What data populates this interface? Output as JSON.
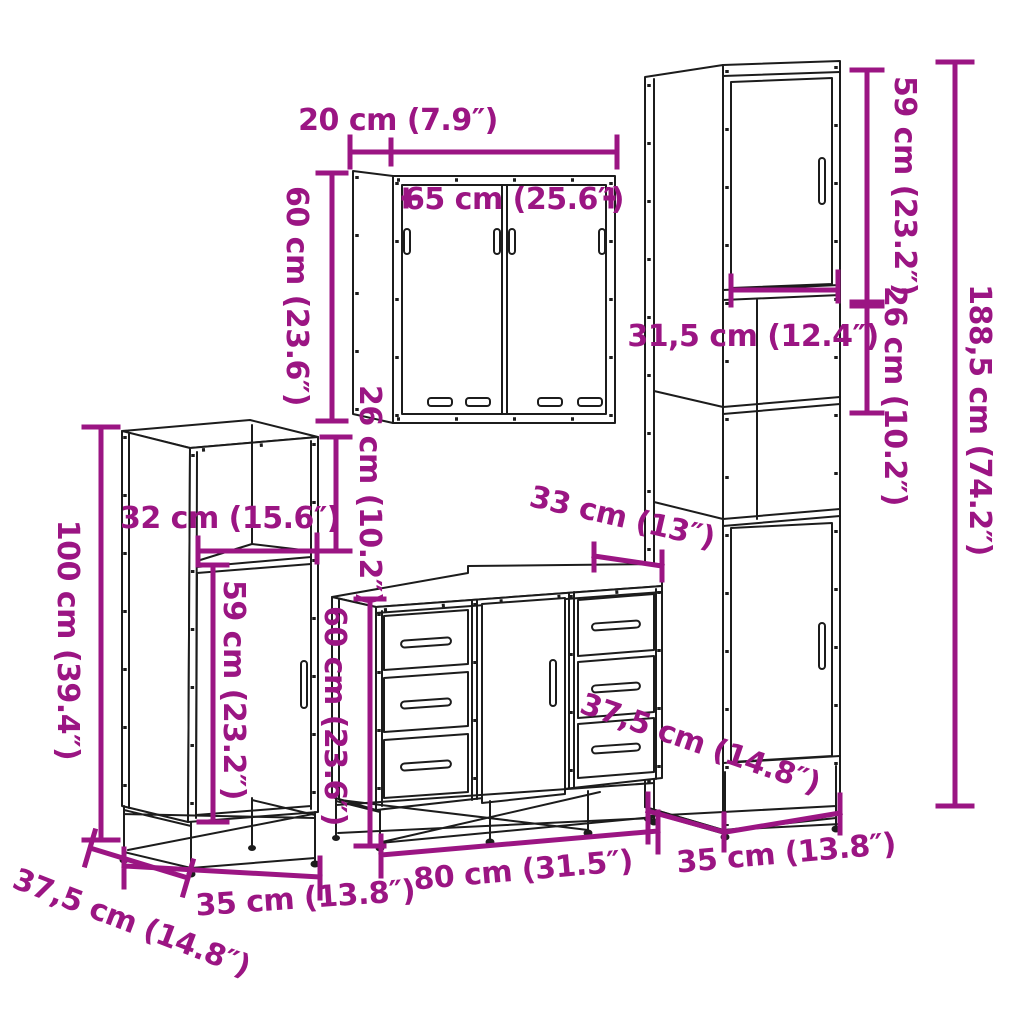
{
  "title": "4 piece bathroom furniture set dimension diagram",
  "colors": {
    "dimension_annotation": "#9B1583",
    "drawing_line": "#1C1C1C",
    "background": "#FFFFFF"
  },
  "dims": {
    "mirror_depth": "20 cm (7.9″)",
    "mirror_width": "65 cm (25.6″)",
    "mirror_height": "60 cm (23.6″)",
    "mirror_vanity_gap": "26 cm (10.2″)",
    "tall_upper_door_height": "59 cm (23.2″)",
    "tall_open_shelf_height": "26 cm (10.2″)",
    "tall_total_height": "188,5 cm (74.2″)",
    "tall_upper_width": "31,5 cm (12.4″)",
    "side_total_height": "100 cm (39.4″)",
    "side_opening_width": "32 cm (15.6″)",
    "side_door_height": "59 cm (23.2″)",
    "side_width": "35 cm (13.8″)",
    "side_depth": "37,5 cm (14.8″)",
    "vanity_height": "60 cm (23.6″)",
    "vanity_top_depth": "33 cm (13″)",
    "tall_depth": "37,5 cm (14.8″)",
    "vanity_width": "80 cm (31.5″)",
    "tall_width": "35 cm (13.8″)"
  }
}
